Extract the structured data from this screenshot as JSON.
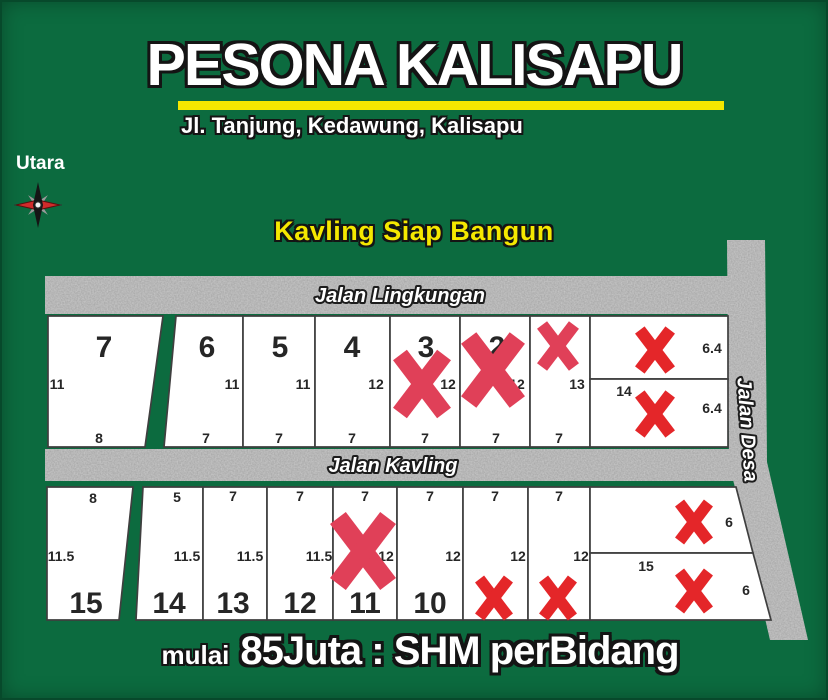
{
  "header": {
    "title": "PESONA KALISAPU",
    "subtitle": "Jl. Tanjung, Kedawung, Kalisapu"
  },
  "compass": {
    "label": "Utara"
  },
  "tagline": "Kavling Siap Bangun",
  "roads": {
    "top": "Jalan Lingkungan",
    "middle": "Jalan Kavling",
    "right": "Jalan Desa"
  },
  "footer": {
    "prefix": "mulai",
    "text": "85Juta : SHM perBidang"
  },
  "colors": {
    "background": "#0c6b3f",
    "road": "#a2a2a2",
    "plot_fill": "#ffffff",
    "plot_border": "#3f3f3f",
    "x_rose": "#e04058",
    "x_red": "#e42629",
    "yellow": "#f5e800",
    "label_dark": "#262626"
  },
  "plots": [
    {
      "id": "7",
      "number": "7",
      "side_dim": "11",
      "bottom_dim": "8",
      "top_dim": "",
      "sold": false
    },
    {
      "id": "6",
      "number": "6",
      "side_dim": "11",
      "bottom_dim": "7",
      "top_dim": "",
      "sold": false
    },
    {
      "id": "5",
      "number": "5",
      "side_dim": "11",
      "bottom_dim": "7",
      "top_dim": "",
      "sold": false
    },
    {
      "id": "4",
      "number": "4",
      "side_dim": "12",
      "bottom_dim": "7",
      "top_dim": "",
      "sold": false
    },
    {
      "id": "3",
      "number": "3",
      "side_dim": "12",
      "bottom_dim": "7",
      "top_dim": "",
      "sold": true
    },
    {
      "id": "2",
      "number": "2",
      "side_dim": "12",
      "bottom_dim": "7",
      "top_dim": "",
      "sold": true
    },
    {
      "id": "1",
      "number": "",
      "side_dim": "13",
      "bottom_dim": "7",
      "top_dim": "",
      "sold": true
    },
    {
      "id": "tr_upper",
      "number": "",
      "side_dim": "6.4",
      "bottom_dim": "",
      "top_dim": "",
      "sold": true
    },
    {
      "id": "tr_lower",
      "number": "",
      "side_dim": "6.4",
      "bottom_dim": "",
      "top_dim": "14",
      "sold": true
    },
    {
      "id": "15",
      "number": "15",
      "side_dim": "11.5",
      "bottom_dim": "",
      "top_dim": "8",
      "sold": false
    },
    {
      "id": "14",
      "number": "14",
      "side_dim": "11.5",
      "bottom_dim": "",
      "top_dim": "5",
      "sold": false
    },
    {
      "id": "13",
      "number": "13",
      "side_dim": "11.5",
      "bottom_dim": "",
      "top_dim": "7",
      "sold": false
    },
    {
      "id": "12",
      "number": "12",
      "side_dim": "11.5",
      "bottom_dim": "",
      "top_dim": "7",
      "sold": false
    },
    {
      "id": "11",
      "number": "11",
      "side_dim": "12",
      "bottom_dim": "",
      "top_dim": "7",
      "sold": true
    },
    {
      "id": "10",
      "number": "10",
      "side_dim": "12",
      "bottom_dim": "",
      "top_dim": "7",
      "sold": false
    },
    {
      "id": "9",
      "number": "",
      "side_dim": "12",
      "bottom_dim": "",
      "top_dim": "7",
      "sold": true
    },
    {
      "id": "8",
      "number": "",
      "side_dim": "12",
      "bottom_dim": "",
      "top_dim": "7",
      "sold": true
    },
    {
      "id": "br_upper",
      "number": "",
      "side_dim": "6",
      "bottom_dim": "",
      "top_dim": "",
      "sold": true
    },
    {
      "id": "br_lower",
      "number": "",
      "side_dim": "6",
      "bottom_dim": "",
      "top_dim": "15",
      "sold": true
    }
  ]
}
